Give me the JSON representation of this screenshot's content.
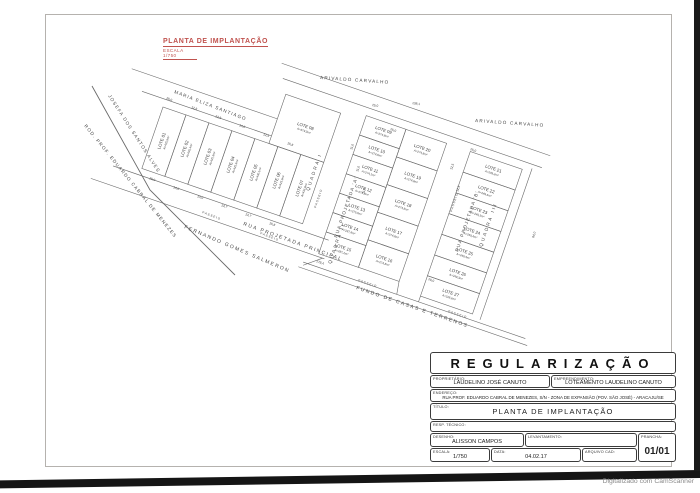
{
  "scan": {
    "watermark": "Digitalizado com CamScanner"
  },
  "drawing_title": {
    "title": "PLANTA DE IMPLANTAÇÃO",
    "scale_note": "ESCALA 1/750",
    "accent_color": "#c0524e"
  },
  "streets": [
    {
      "label": "ROD. PROF. EDUARDO CABRAL DE MENEZES"
    },
    {
      "label": "JOSEFA DOS SANTOS ALVES"
    },
    {
      "label": "MARIA ELIZA SANTIAGO"
    },
    {
      "label": "ARIVALDO CARVALHO"
    },
    {
      "label": "ARIVALDO CARVALHO"
    },
    {
      "label": "RUA PROJETADA 'A'"
    },
    {
      "label": "RUA PROJETADA 'B'"
    },
    {
      "label": "RUA PROJETADA PRINCIPAL"
    },
    {
      "label": "FERNANDO GOMES SALMERON"
    },
    {
      "label": "FUNDO DE CASAS E TERRENOS"
    }
  ],
  "quadras": [
    {
      "label": "QUADRA I"
    },
    {
      "label": "QUADRA II"
    },
    {
      "label": "QUADRA III"
    }
  ],
  "sidewalk_label": "PASSEIO",
  "lots": [
    {
      "name": "LOTE 01",
      "area": "A=425,9m²"
    },
    {
      "name": "LOTE 02",
      "area": "A=430,4m²"
    },
    {
      "name": "LOTE 03",
      "area": "A=425,9m²"
    },
    {
      "name": "LOTE 04",
      "area": "A=425,9m²"
    },
    {
      "name": "LOTE 05",
      "area": "A=430,1m²"
    },
    {
      "name": "LOTE 06",
      "area": "A=425,9m²"
    },
    {
      "name": "LOTE 07",
      "area": "A=433,8m²"
    },
    {
      "name": "LOTE 08",
      "area": "A=379,0m²"
    },
    {
      "name": "LOTE 09",
      "area": "A=274,8m²"
    },
    {
      "name": "LOTE 10",
      "area": "A=274,8m²"
    },
    {
      "name": "LOTE 11",
      "area": "A=274,1m²"
    },
    {
      "name": "LOTE 12",
      "area": "A=274,8m²"
    },
    {
      "name": "LOTE 13",
      "area": "A=275,0m²"
    },
    {
      "name": "LOTE 14",
      "area": "A=287,8m²"
    },
    {
      "name": "LOTE 15",
      "area": "A=287,2m²"
    },
    {
      "name": "LOTE 16",
      "area": "A=274,8m²"
    },
    {
      "name": "LOTE 17",
      "area": "A=274,8m²"
    },
    {
      "name": "LOTE 18",
      "area": "A=274,8m²"
    },
    {
      "name": "LOTE 19",
      "area": "A=274,8m²"
    },
    {
      "name": "LOTE 20",
      "area": "A=274,8m²"
    },
    {
      "name": "LOTE 21",
      "area": "A=249,3m²"
    },
    {
      "name": "LOTE 22",
      "area": "A=249,4m²"
    },
    {
      "name": "LOTE 23",
      "area": "A=249,3m²"
    },
    {
      "name": "LOTE 24",
      "area": "A=249,4m²"
    },
    {
      "name": "LOTE 25",
      "area": "A=249,4m²"
    },
    {
      "name": "LOTE 26",
      "area": "A=249,3m²"
    },
    {
      "name": "LOTE 27",
      "area": "A=318,6m²"
    }
  ],
  "dimensions": [
    "25,0",
    "12,5",
    "12,5",
    "14,0",
    "12,5",
    "15,8",
    "15,0",
    "14,0",
    "14,0",
    "13,7",
    "13,7",
    "15,8",
    "25,0",
    "138,1",
    "25,0",
    "11,0",
    "11,0",
    "11,0",
    "12,5",
    "12,5",
    "178,4",
    "84,0",
    "25,0",
    "20,0"
  ],
  "title_block": {
    "main_title": "REGULARIZAÇÃO",
    "fields": {
      "proprietario_label": "PROPRIETÁRIO:",
      "proprietario": "LAUDELINO JOSÉ CANUTO",
      "empreendimento_label": "EMPREENDIMENTO:",
      "empreendimento": "LOTEAMENTO LAUDELINO CANUTO",
      "endereco_label": "ENDEREÇO:",
      "endereco": "RUA PROF. EDUARDO CABRAL DE MENEZES, S/N - ZONA DE EXPANSÃO (POV. SÃO JOSÉ) - ARACAJU/SE",
      "titulo_label": "TÍTULO:",
      "titulo": "PLANTA DE IMPLANTAÇÃO",
      "resp_label": "RESP. TÉCNICO:",
      "resp": "",
      "desenho_label": "DESENHO:",
      "desenho": "ALISSON CAMPOS",
      "levantamento_label": "LEVANTAMENTO:",
      "levantamento": "",
      "prancha_label": "PRANCHA:",
      "prancha": "01/01",
      "escala_label": "ESCALA:",
      "escala": "1/750",
      "data_label": "DATA:",
      "data": "04.02.17",
      "arquivo_label": "ARQUIVO CAD:",
      "arquivo": ""
    }
  }
}
